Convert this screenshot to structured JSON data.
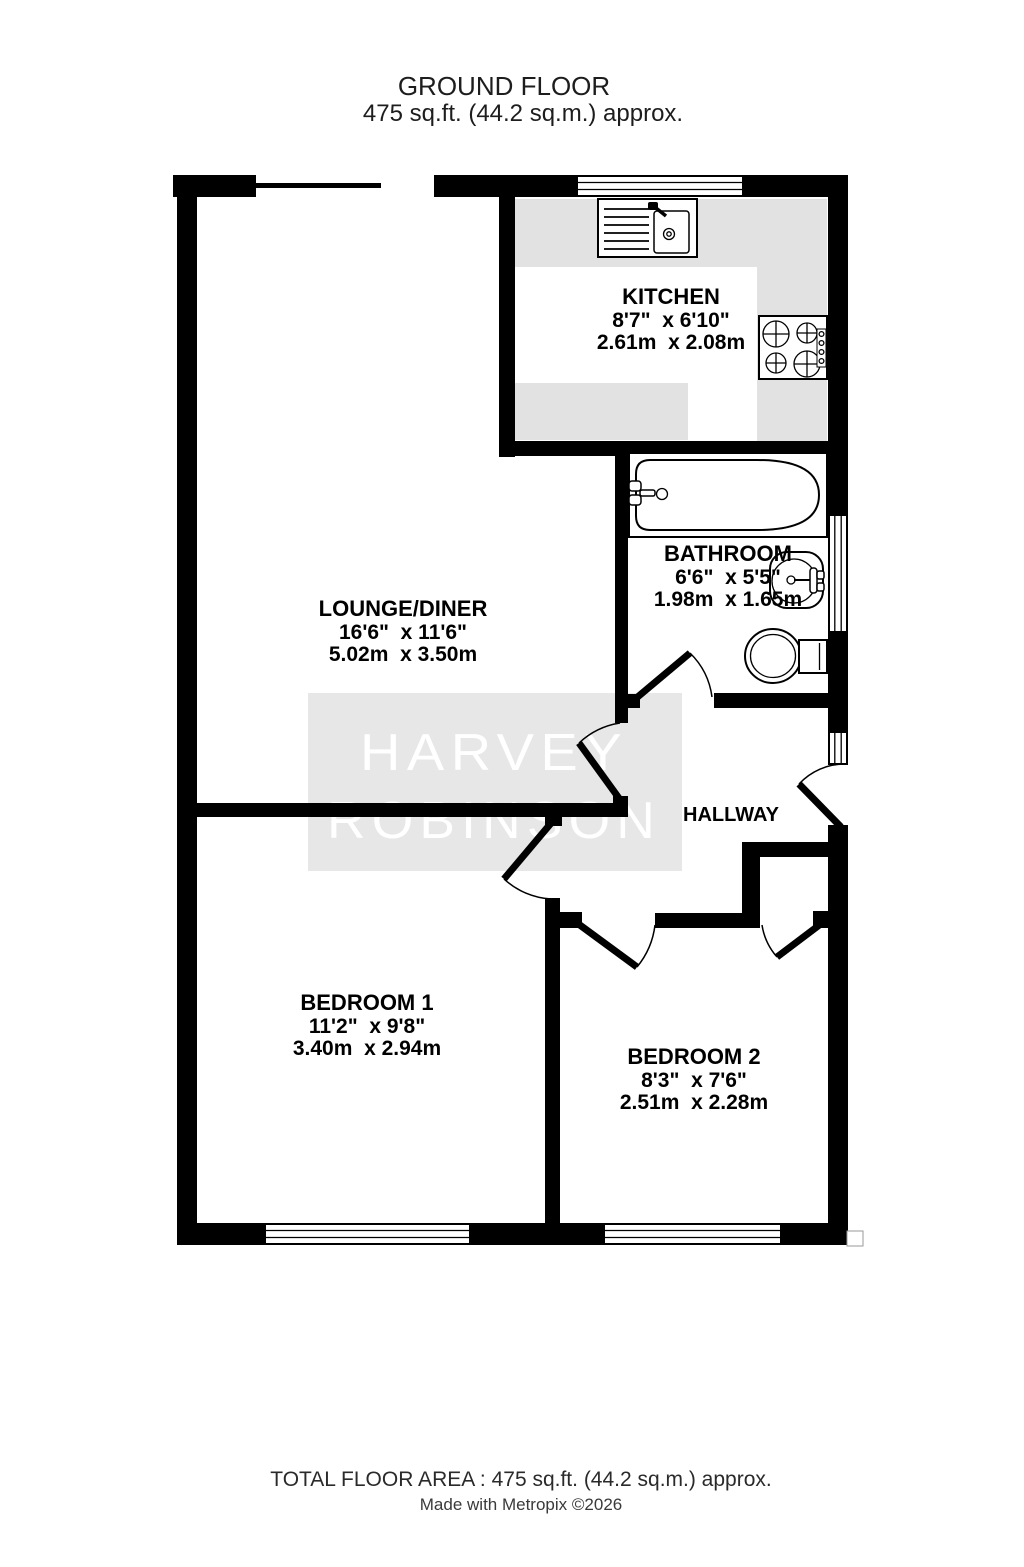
{
  "title": {
    "line1": "GROUND FLOOR",
    "line2": "475 sq.ft. (44.2 sq.m.) approx."
  },
  "watermark": {
    "line1": "HARVEY",
    "line2": "ROBINSON"
  },
  "rooms": {
    "kitchen": {
      "name": "KITCHEN",
      "imperial": "8'7\"  x 6'10\"",
      "metric": "2.61m  x 2.08m"
    },
    "bathroom": {
      "name": "BATHROOM",
      "imperial": "6'6\"  x 5'5\"",
      "metric": "1.98m  x 1.65m"
    },
    "lounge": {
      "name": "LOUNGE/DINER",
      "imperial": "16'6\"  x 11'6\"",
      "metric": "5.02m  x 3.50m"
    },
    "hallway": {
      "name": "HALLWAY"
    },
    "bedroom1": {
      "name": "BEDROOM 1",
      "imperial": "11'2\"  x 9'8\"",
      "metric": "3.40m  x 2.94m"
    },
    "bedroom2": {
      "name": "BEDROOM 2",
      "imperial": "8'3\"  x 7'6\"",
      "metric": "2.51m  x 2.28m"
    }
  },
  "footer": {
    "area": "TOTAL FLOOR AREA : 475 sq.ft. (44.2 sq.m.) approx.",
    "credit": "Made with Metropix ©2026"
  },
  "colors": {
    "wall": "#000000",
    "counter": "#e2e2e2",
    "watermark_band": "#e7e7e7",
    "watermark_text": "#ffffff",
    "floor": "#ffffff"
  }
}
